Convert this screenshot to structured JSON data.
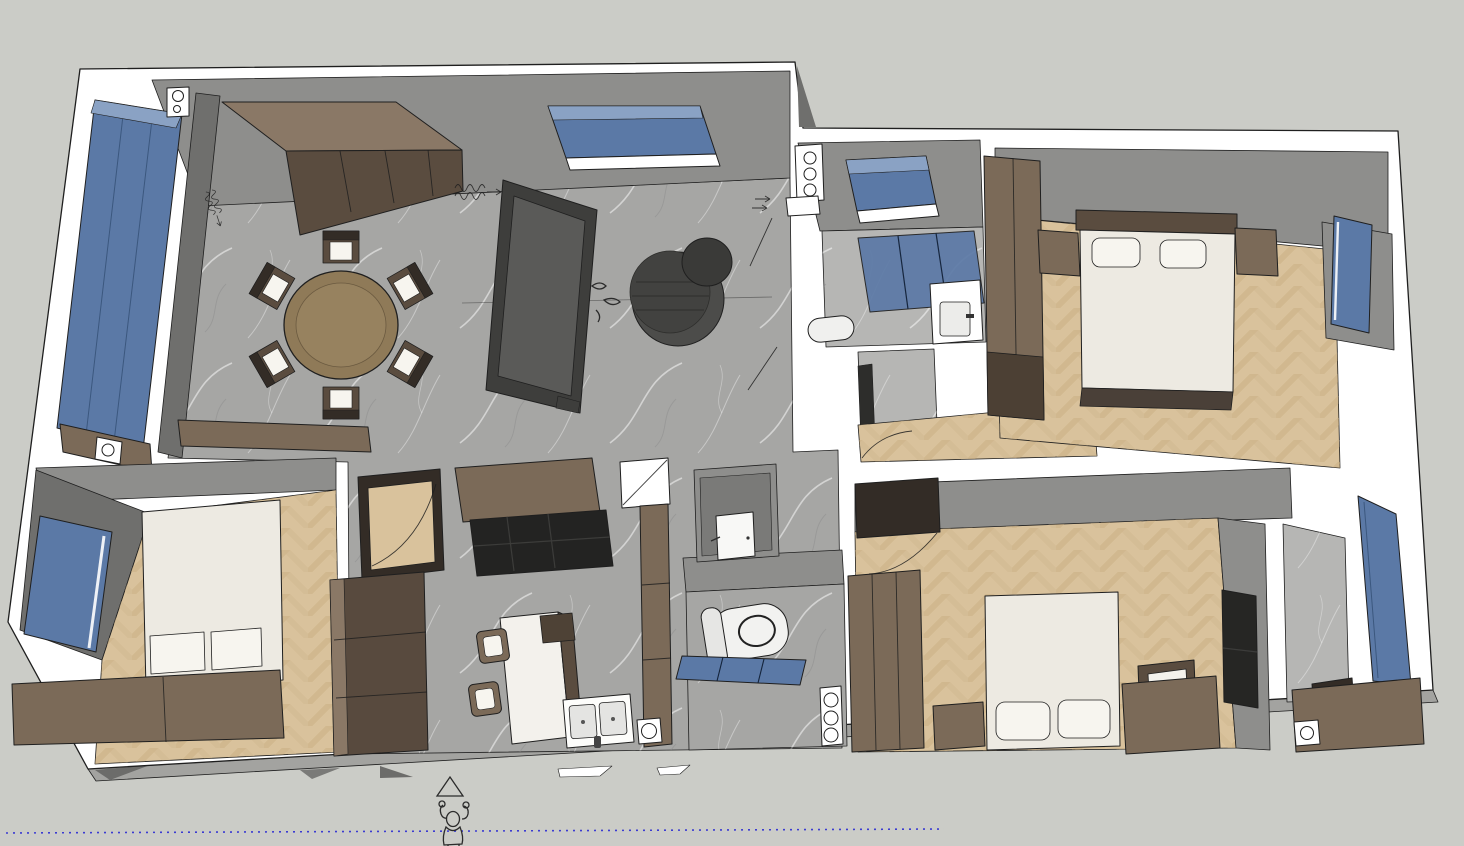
{
  "app": {
    "kind": "3d-floorplan-viewport",
    "view": "elevated-perspective"
  },
  "palette": {
    "canvas": "#cbccc7",
    "outline": "#1f1f1f",
    "wallWhite": "#ffffff",
    "wallFace": "#8e8e8c",
    "wallFaceDark": "#6f6f6d",
    "marble": "#a6a6a4",
    "marbleLight": "#b6b6b4",
    "wood": "#d9c29c",
    "brown": "#8a7866",
    "brownMid": "#7b6a58",
    "brownDark": "#5a4c3f",
    "darkWood": "#332c26",
    "sofa": "#3e3e3c",
    "sofaSeat": "#5a5a58",
    "tableDark": "#4c4c4a",
    "glassBlue": "#5b79a6",
    "glassBlueLight": "#8aa2c4",
    "bedWhite": "#edeae2",
    "pillowWhite": "#f7f5ef",
    "counterWhite": "#f3f1ec",
    "applianceDark": "#232322",
    "skirt": "#a3a3a0",
    "guideBlue": "#3b3bd1",
    "figureInk": "#2b2b2b"
  },
  "scene": {
    "rooms": [
      {
        "id": "living-dining",
        "floor": "gray-marble"
      },
      {
        "id": "kitchen",
        "floor": "gray-marble"
      },
      {
        "id": "bathroom-top",
        "floor": "gray-marble"
      },
      {
        "id": "laundry-nook",
        "floor": "gray-marble"
      },
      {
        "id": "hallway",
        "floor": "wood-herringbone"
      },
      {
        "id": "wc",
        "floor": "gray-marble"
      },
      {
        "id": "bedroom-top-right",
        "floor": "wood-herringbone"
      },
      {
        "id": "bedroom-bottom-left",
        "floor": "wood-herringbone"
      },
      {
        "id": "bedroom-bottom-right",
        "floor": "wood-herringbone"
      },
      {
        "id": "bathroom-bottom-right",
        "floor": "gray-marble"
      },
      {
        "id": "balcony-glazing",
        "floor": "glass"
      }
    ],
    "furniture": [
      "sideboard",
      "dining-table",
      "dining-chair",
      "sofa",
      "coffee-table",
      "kitchen-upper-cabinet",
      "cooktop-counter",
      "kitchen-island",
      "bar-stool",
      "double-sink",
      "tall-cabinet",
      "toilet",
      "shower-glass",
      "washbasin",
      "skylight-window",
      "bed",
      "wardrobe",
      "nightstand",
      "dresser-with-mirror",
      "tv-panel",
      "vanity-counter",
      "window-glass",
      "interior-door"
    ],
    "counts": {
      "dining_chairs": 6,
      "bar_stools": 2,
      "beds": 3
    },
    "annotations": {
      "scale_figure": "human-outline",
      "north_marker": "triangle",
      "guide_line": "blue-dotted",
      "radiator_symbol": "zigzag-with-arrow"
    }
  }
}
